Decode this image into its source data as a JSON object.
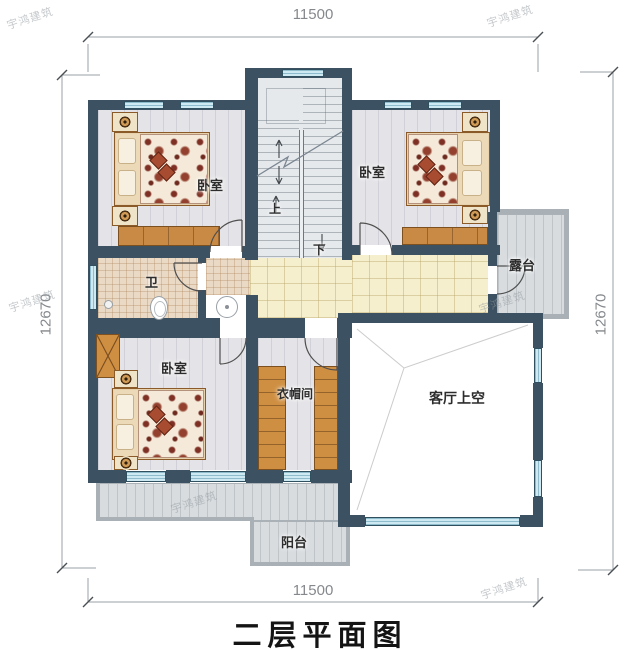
{
  "title": {
    "text": "二层平面图"
  },
  "watermark": {
    "text": "宇鸿建筑"
  },
  "dimensions": {
    "top": "11500",
    "bottom": "11500",
    "left": "12670",
    "right": "12670"
  },
  "rooms": {
    "bedroom_top_left": "卧室",
    "bedroom_top_right": "卧室",
    "bedroom_bottom_left": "卧室",
    "bathroom": "卫",
    "cloakroom": "衣帽间",
    "living_void": "客厅上空",
    "terrace": "露台",
    "balcony": "阳台"
  },
  "stairs": {
    "up": "上",
    "down": "下"
  },
  "colors": {
    "wall": "#3c5161",
    "window": "#cfe9f3",
    "hall_floor": "#f6efcd",
    "wood_furniture": "#c98a45",
    "duvet_accent": "#7e3024",
    "terrace_floor": "#d8dcdf"
  }
}
